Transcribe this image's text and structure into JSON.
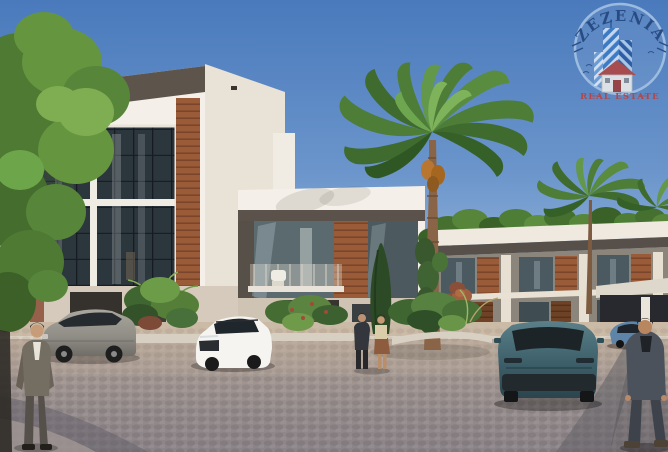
{
  "watermark": {
    "brand": "ZEZENIA",
    "tagline": "REAL ESTATE"
  },
  "scene": {
    "type": "3d-architectural-render",
    "subject": "modern villa compound street view",
    "vehicles": [
      {
        "name": "silver-suv-parked-left",
        "color": "#97948c"
      },
      {
        "name": "white-suv-parked-center",
        "color": "#f5f4f0"
      },
      {
        "name": "teal-suv-driving-right",
        "color": "#3f626c"
      },
      {
        "name": "blue-car-distant-right",
        "color": "#5e84a8"
      }
    ],
    "people": [
      {
        "name": "man-gray-suit-left"
      },
      {
        "name": "couple-talking-center"
      },
      {
        "name": "man-dark-suit-right"
      }
    ],
    "landscape": [
      "leafy-tree-left",
      "large-palm-center",
      "small-palm-right",
      "cypress",
      "shrub-planters",
      "roof-hedge"
    ]
  },
  "colors": {
    "sky_top": "#4a7abc",
    "sky_horizon": "#c8d7ea",
    "villa_white": "#f4f0e9",
    "fascia_dark": "#5d544c",
    "wood": "#9a5c38",
    "glass": "#2c363d",
    "road": "#a39894",
    "foliage": "#55803a",
    "logo_navy": "#23437a",
    "logo_red": "#c23b35",
    "logo_blue": "#3a79c6"
  }
}
